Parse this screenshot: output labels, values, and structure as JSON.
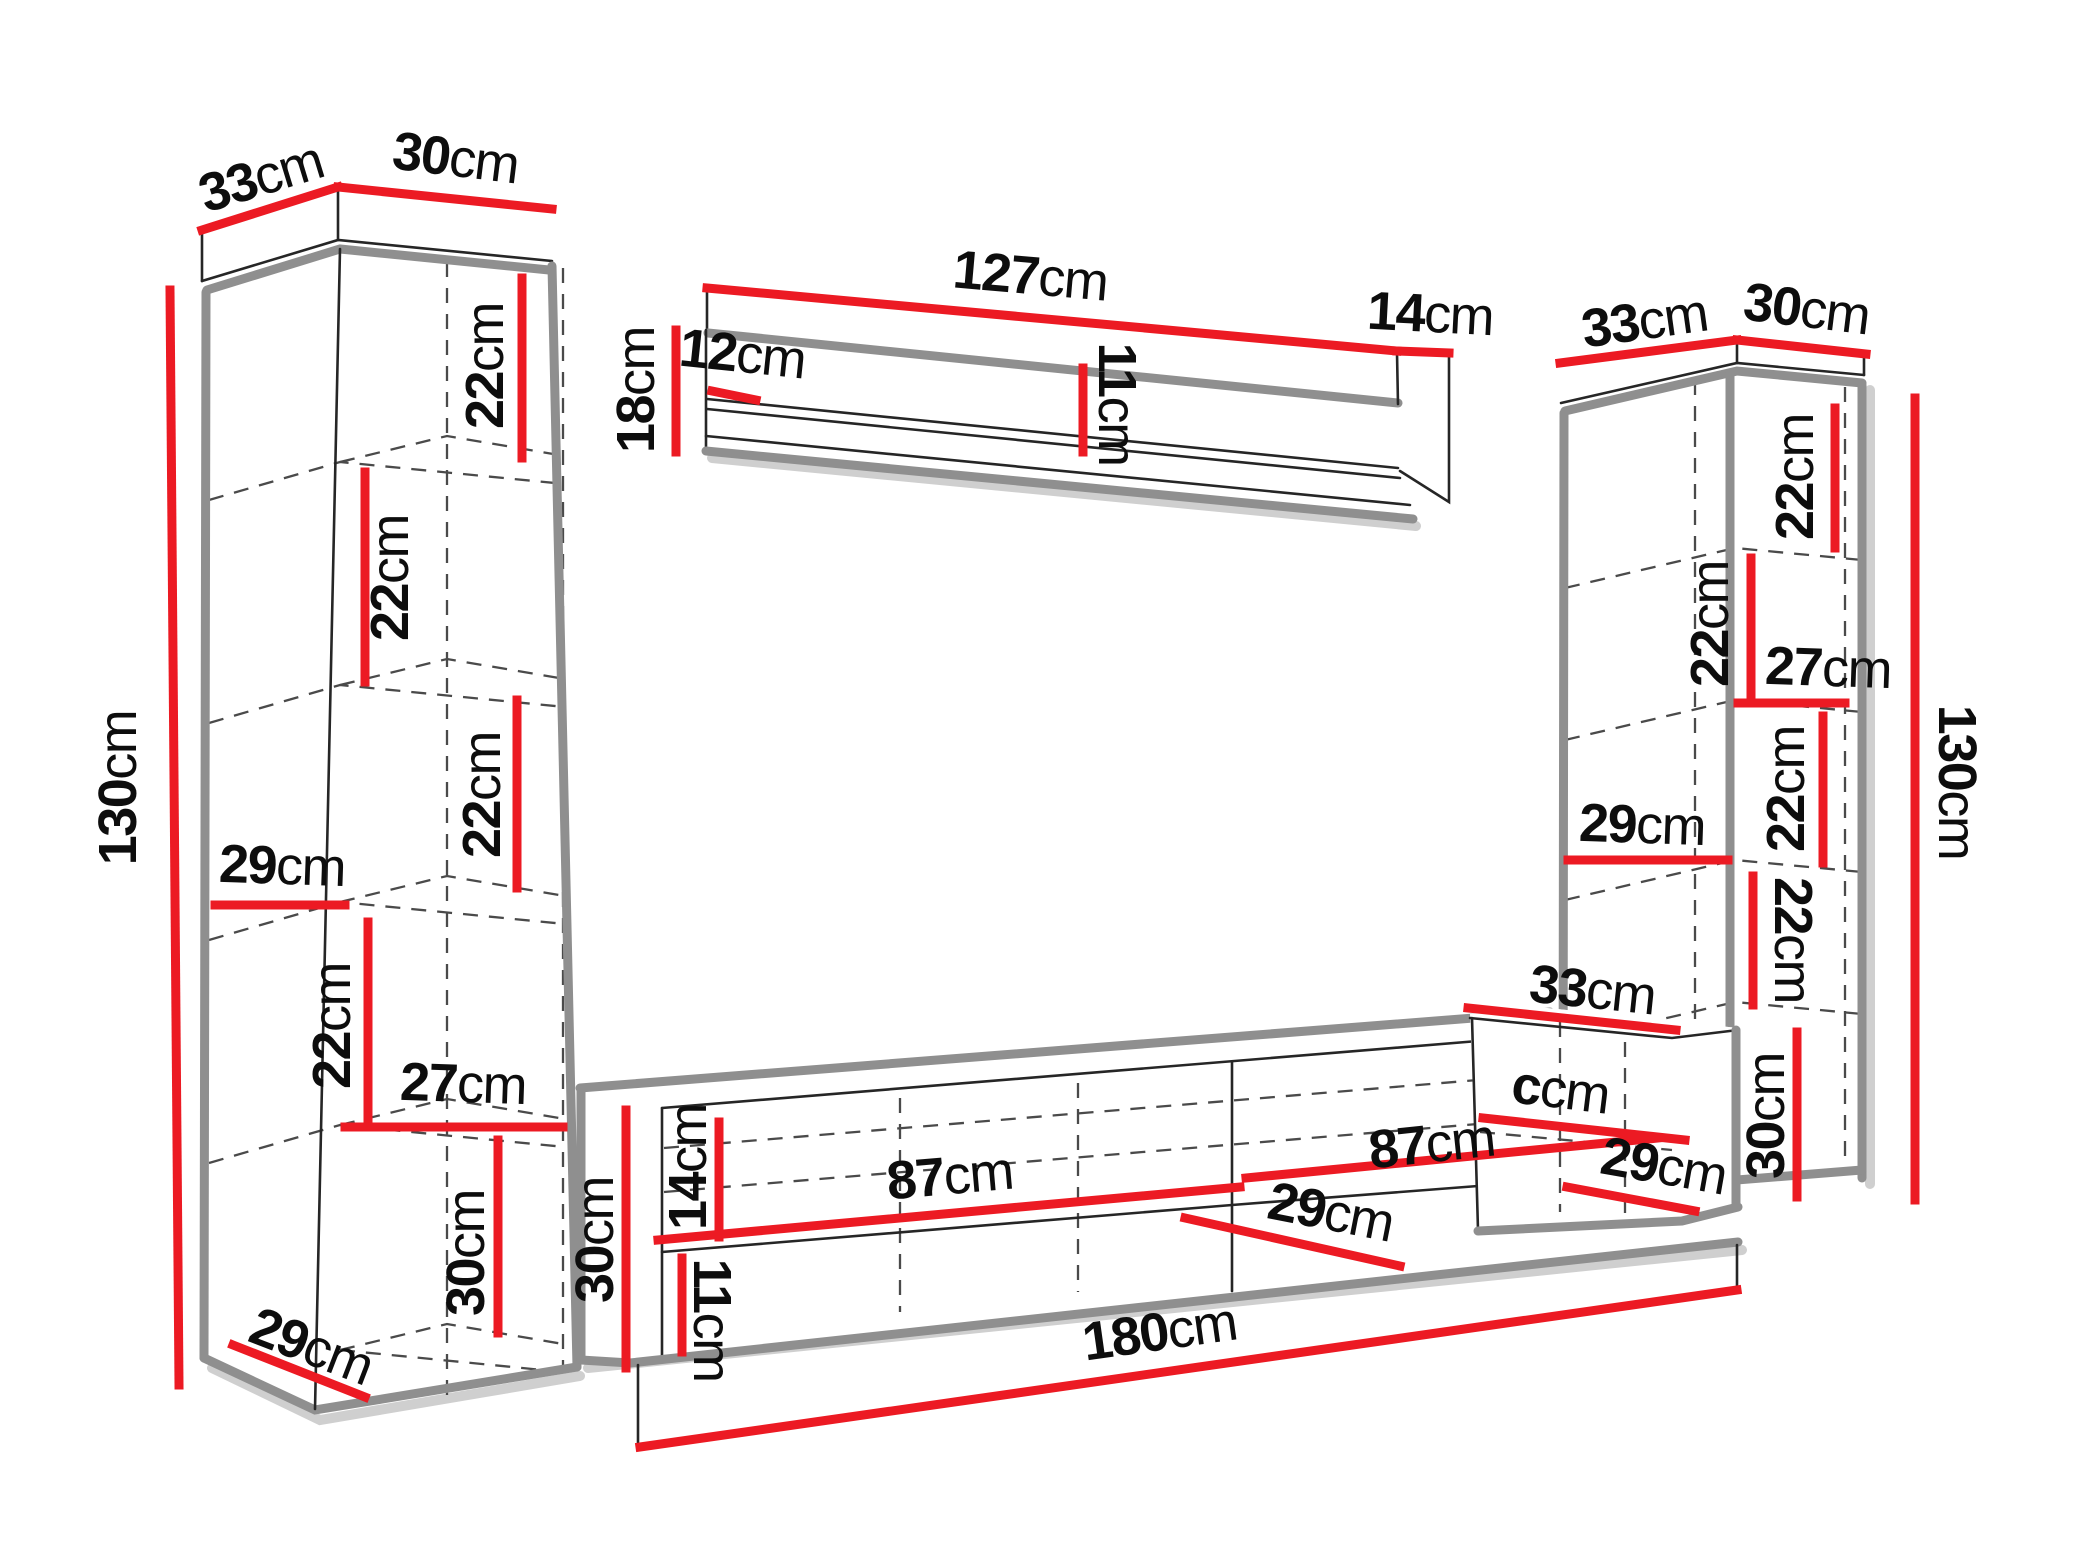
{
  "figure": {
    "type": "furniture-dimension-diagram",
    "background": "#ffffff"
  },
  "unit": "cm",
  "colors": {
    "dimension_line": "#ec1a23",
    "label_text": "#0d0d0d",
    "edge": "#8f8f8f",
    "outline": "#262626",
    "hidden_line": "#4a4a4a"
  },
  "diagram": {
    "left_cabinet": {
      "top_depth": {
        "value": "33",
        "unit": "cm"
      },
      "top_width": {
        "value": "30",
        "unit": "cm"
      },
      "height": {
        "value": "130",
        "unit": "cm"
      },
      "shelf_1_height": {
        "value": "22",
        "unit": "cm"
      },
      "shelf_2_height": {
        "value": "22",
        "unit": "cm"
      },
      "shelf_3_height": {
        "value": "22",
        "unit": "cm"
      },
      "inner_depth": {
        "value": "29",
        "unit": "cm"
      },
      "shelf_4_height": {
        "value": "22",
        "unit": "cm"
      },
      "inner_width": {
        "value": "27",
        "unit": "cm"
      },
      "bottom_section_height": {
        "value": "30",
        "unit": "cm"
      },
      "bottom_depth": {
        "value": "29",
        "unit": "cm"
      }
    },
    "wall_shelf": {
      "length": {
        "value": "127",
        "unit": "cm"
      },
      "height": {
        "value": "18",
        "unit": "cm"
      },
      "back_panel_height": {
        "value": "12",
        "unit": "cm"
      },
      "inner_height": {
        "value": "11",
        "unit": "cm"
      },
      "end_depth": {
        "value": "14",
        "unit": "cm"
      }
    },
    "right_cabinet": {
      "top_depth": {
        "value": "33",
        "unit": "cm"
      },
      "top_width": {
        "value": "30",
        "unit": "cm"
      },
      "height": {
        "value": "130",
        "unit": "cm"
      },
      "shelf_1_height": {
        "value": "22",
        "unit": "cm"
      },
      "shelf_2_height": {
        "value": "22",
        "unit": "cm"
      },
      "inner_width": {
        "value": "27",
        "unit": "cm"
      },
      "shelf_3_height": {
        "value": "22",
        "unit": "cm"
      },
      "inner_depth": {
        "value": "29",
        "unit": "cm"
      },
      "shelf_4_height": {
        "value": "22",
        "unit": "cm"
      }
    },
    "tv_stand": {
      "height": {
        "value": "30",
        "unit": "cm"
      },
      "top_panel_height": {
        "value": "14",
        "unit": "cm"
      },
      "opening_height": {
        "value": "11",
        "unit": "cm"
      },
      "left_section_width": {
        "value": "87",
        "unit": "cm"
      },
      "right_section_width": {
        "value": "87",
        "unit": "cm"
      },
      "inner_depth": {
        "value": "29",
        "unit": "cm"
      },
      "total_width": {
        "value": "180",
        "unit": "cm"
      },
      "right_end_top_depth": {
        "value": "33",
        "unit": "cm"
      },
      "right_end_partial_label": {
        "value": "c",
        "unit": "cm"
      },
      "right_end_inner_depth": {
        "value": "29",
        "unit": "cm"
      },
      "right_end_height": {
        "value": "30",
        "unit": "cm"
      }
    }
  }
}
